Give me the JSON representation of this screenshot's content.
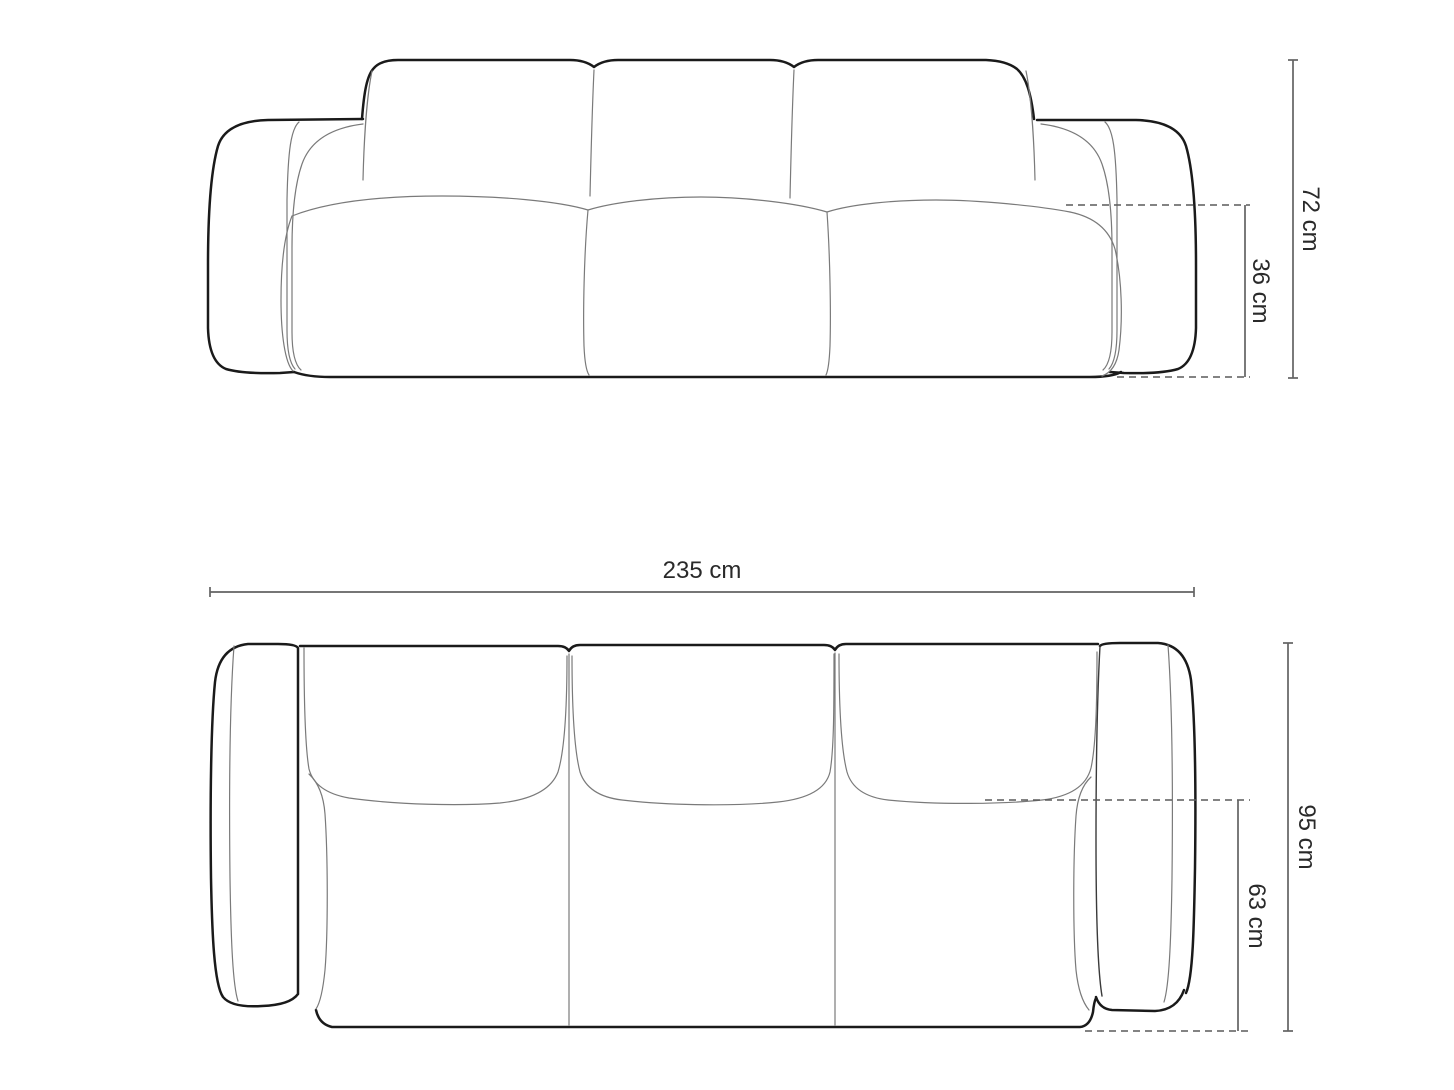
{
  "front_view": {
    "dimensions": {
      "total_height": "72 cm",
      "seat_height": "36 cm"
    }
  },
  "top_view": {
    "dimensions": {
      "total_width": "235 cm",
      "total_depth": "95 cm",
      "seat_depth": "63 cm"
    }
  },
  "colors": {
    "background": "#ffffff",
    "outline": "#1a1a1a",
    "seam": "#7a7a7a",
    "dimension_line": "#636363",
    "dashed_line": "#5a5a5a",
    "label_text": "#2a2a2a"
  }
}
